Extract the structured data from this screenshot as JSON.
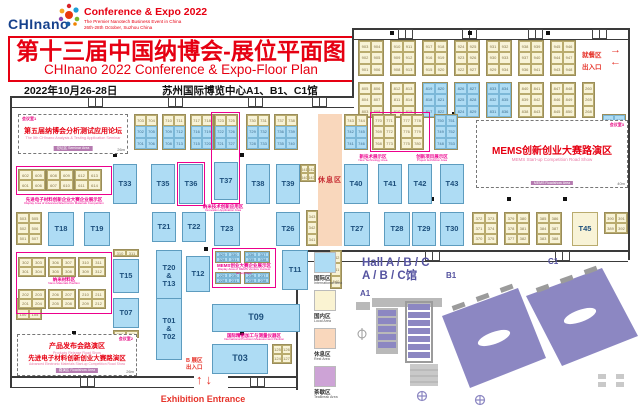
{
  "header": {
    "logo_text": "CHInano",
    "expo_line1": "Conference & Expo 2022",
    "expo_line2": "The Premier Nanotech Business Event in China",
    "expo_line3": "26th-28th October, Suzhou China",
    "title_cn": "第十三届中国纳博会-展位平面图",
    "title_en": "CHInano 2022 Conference & Expo-Floor Plan",
    "date": "2022年10月26-28日",
    "venue": "苏州国际博览中心A1、B1、C1馆"
  },
  "labels": {
    "dining": "就餐区",
    "dining_arrow": "→",
    "exit": "出入口",
    "exit_arrow": "←",
    "rest": "休息区",
    "b_hall": "B 展区",
    "b_entrance": "出入口",
    "arrow_up": "↑",
    "arrow_down": "↓",
    "exhibition_entrance": "Exhibition Entrance"
  },
  "rooms": [
    {
      "x": 18,
      "y": 114,
      "w": 110,
      "h": 40,
      "corner": "会议室1",
      "cpos": "l",
      "dim": "26m",
      "tag": "论坛区 Seminar Area",
      "lines": [
        {
          "t": "第五届纳博会分析测试应用论坛",
          "s": "cn",
          "fs": 7
        },
        {
          "t": "The 5th CHInano Analysis & Testing Application Seminar",
          "s": "en",
          "fs": 3.8
        }
      ]
    },
    {
      "x": 476,
      "y": 120,
      "w": 152,
      "h": 68,
      "corner": "会议室3",
      "cpos": "r",
      "dim": "40m",
      "tag": "MEMS Roadshow Area",
      "lines": [
        {
          "t": "MEMS创新创业大赛路演区",
          "s": "cn",
          "fs": 10
        },
        {
          "t": "MEMS Start-up Competition Road Show",
          "s": "en",
          "fs": 4.5
        }
      ]
    },
    {
      "x": 17,
      "y": 334,
      "w": 120,
      "h": 42,
      "corner": "会议室2",
      "cpos": "r",
      "dim": "26m",
      "tag": "路演区 Roadshow Area",
      "lines": [
        {
          "t": "产品发布会路演区",
          "s": "cn",
          "fs": 7
        },
        {
          "t": "Products Release Road Show",
          "s": "en",
          "fs": 3.6
        },
        {
          "t": "先进电子材料创新创业大赛路演区",
          "s": "cn",
          "fs": 6.5
        },
        {
          "t": "Advanced Electronic Materials Start-up Competition Road Show",
          "s": "en",
          "fs": 3.4
        }
      ]
    }
  ],
  "zones": [
    {
      "x": 16,
      "y": 166,
      "w": 96,
      "h": 29
    },
    {
      "x": 177,
      "y": 162,
      "w": 28,
      "h": 44
    },
    {
      "x": 211,
      "y": 112,
      "w": 29,
      "h": 92
    },
    {
      "x": 370,
      "y": 112,
      "w": 60,
      "h": 40
    },
    {
      "x": 16,
      "y": 252,
      "w": 96,
      "h": 62
    },
    {
      "x": 212,
      "y": 248,
      "w": 64,
      "h": 40
    }
  ],
  "zone_labels": [
    {
      "x": 2,
      "y": 197,
      "w": 124,
      "cn": "先进电子材料创新企业大赛企业展示区",
      "en": "Display Area of Advanced Electronics Materials Competition"
    },
    {
      "x": 168,
      "y": 204,
      "w": 110,
      "cn": "纳米技术创新应用区",
      "en": "Innovation Application Area"
    },
    {
      "x": 346,
      "y": 154,
      "w": 54,
      "cn": "新技术展示区",
      "en": "New Technology Area"
    },
    {
      "x": 400,
      "y": 154,
      "w": 64,
      "cn": "创新项目展示区",
      "en": "Project Exhibition Area"
    },
    {
      "x": 16,
      "y": 277,
      "w": 96,
      "cn": "纳米材料区",
      "en": "Nano Materials Pavilion"
    },
    {
      "x": 212,
      "y": 263,
      "w": 64,
      "cn": "MEMS创业大赛企业展示区",
      "en": "Display Area of MEMS Venture Contest Enterprises"
    },
    {
      "x": 196,
      "y": 333,
      "w": 116,
      "cn": "国际精密加工与测量仪器区",
      "en": "International Precision Measurement Pavilion"
    }
  ],
  "t_booths": [
    {
      "id": "T33",
      "x": 113,
      "y": 164,
      "w": 24,
      "h": 40
    },
    {
      "id": "T35",
      "x": 151,
      "y": 164,
      "w": 24,
      "h": 40
    },
    {
      "id": "T36",
      "x": 179,
      "y": 164,
      "w": 24,
      "h": 40
    },
    {
      "id": "T37",
      "x": 214,
      "y": 162,
      "w": 24,
      "h": 38
    },
    {
      "id": "T38",
      "x": 246,
      "y": 164,
      "w": 24,
      "h": 40
    },
    {
      "id": "T39",
      "x": 276,
      "y": 164,
      "w": 24,
      "h": 40
    },
    {
      "id": "T40",
      "x": 344,
      "y": 164,
      "w": 24,
      "h": 40
    },
    {
      "id": "T41",
      "x": 378,
      "y": 164,
      "w": 24,
      "h": 40
    },
    {
      "id": "T42",
      "x": 408,
      "y": 164,
      "w": 24,
      "h": 40
    },
    {
      "id": "T43",
      "x": 440,
      "y": 164,
      "w": 24,
      "h": 40
    },
    {
      "id": "T18",
      "x": 48,
      "y": 212,
      "w": 26,
      "h": 34
    },
    {
      "id": "T19",
      "x": 84,
      "y": 212,
      "w": 26,
      "h": 34
    },
    {
      "id": "T21",
      "x": 152,
      "y": 212,
      "w": 24,
      "h": 30
    },
    {
      "id": "T22",
      "x": 182,
      "y": 212,
      "w": 24,
      "h": 30
    },
    {
      "id": "T23",
      "x": 214,
      "y": 212,
      "w": 26,
      "h": 34
    },
    {
      "id": "T26",
      "x": 276,
      "y": 212,
      "w": 24,
      "h": 34
    },
    {
      "id": "T27",
      "x": 344,
      "y": 212,
      "w": 26,
      "h": 34
    },
    {
      "id": "T28",
      "x": 384,
      "y": 212,
      "w": 26,
      "h": 34
    },
    {
      "id": "T29",
      "x": 412,
      "y": 212,
      "w": 24,
      "h": 34
    },
    {
      "id": "T30",
      "x": 440,
      "y": 212,
      "w": 24,
      "h": 34
    },
    {
      "id": "T45",
      "x": 572,
      "y": 212,
      "w": 26,
      "h": 34,
      "cream": 1
    },
    {
      "id": "T20T13",
      "label": "T20\n&\nT13",
      "x": 156,
      "y": 250,
      "w": 26,
      "h": 52
    },
    {
      "id": "T15",
      "x": 113,
      "y": 259,
      "w": 26,
      "h": 34
    },
    {
      "id": "T12",
      "x": 186,
      "y": 256,
      "w": 24,
      "h": 36
    },
    {
      "id": "T11",
      "x": 282,
      "y": 250,
      "w": 26,
      "h": 40
    },
    {
      "id": "T07",
      "x": 113,
      "y": 298,
      "w": 26,
      "h": 30
    },
    {
      "id": "T01T02",
      "label": "T01\n&\nT02",
      "x": 156,
      "y": 298,
      "w": 26,
      "h": 62
    },
    {
      "id": "T09",
      "x": 212,
      "y": 304,
      "w": 88,
      "h": 28,
      "fs": 9
    },
    {
      "id": "T03",
      "x": 212,
      "y": 344,
      "w": 56,
      "h": 30,
      "fs": 9
    }
  ],
  "blocks": [
    {
      "x": 358,
      "y": 40,
      "n": [
        "903",
        "904",
        "902",
        "905",
        "901",
        "906"
      ]
    },
    {
      "x": 390,
      "y": 40,
      "n": [
        "910",
        "911",
        "909",
        "912",
        "908",
        "913"
      ]
    },
    {
      "x": 422,
      "y": 40,
      "n": [
        "917",
        "918",
        "916",
        "919",
        "915",
        "920"
      ]
    },
    {
      "x": 454,
      "y": 40,
      "n": [
        "924",
        "925",
        "923",
        "926",
        "922",
        "927"
      ]
    },
    {
      "x": 486,
      "y": 40,
      "n": [
        "931",
        "932",
        "930",
        "933",
        "929",
        "934"
      ]
    },
    {
      "x": 518,
      "y": 40,
      "n": [
        "938",
        "939",
        "937",
        "940",
        "936",
        "941"
      ]
    },
    {
      "x": 550,
      "y": 40,
      "n": [
        "945",
        "946",
        "944",
        "947",
        "943",
        "948"
      ]
    },
    {
      "x": 358,
      "y": 82,
      "n": [
        "805",
        "806",
        "804",
        "807",
        "803",
        "808"
      ]
    },
    {
      "x": 390,
      "y": 82,
      "n": [
        "812",
        "813",
        "811",
        "814",
        "810",
        "815"
      ]
    },
    {
      "x": 422,
      "y": 82,
      "k": "b",
      "n": [
        "819",
        "820",
        "818",
        "821",
        "817",
        "822"
      ]
    },
    {
      "x": 454,
      "y": 82,
      "k": "b",
      "n": [
        "826",
        "827",
        "825",
        "828",
        "824",
        "829"
      ]
    },
    {
      "x": 486,
      "y": 82,
      "k": "b",
      "n": [
        "833",
        "834",
        "832",
        "835",
        "831",
        "836"
      ]
    },
    {
      "x": 518,
      "y": 82,
      "n": [
        "840",
        "841",
        "839",
        "842",
        "838",
        "843"
      ]
    },
    {
      "x": 550,
      "y": 82,
      "n": [
        "847",
        "848",
        "846",
        "849",
        "845",
        "850"
      ]
    },
    {
      "x": 582,
      "y": 82,
      "c": 1,
      "n": [
        "260",
        "265",
        "268"
      ]
    },
    {
      "x": 134,
      "y": 114,
      "k": "m",
      "cw": 12,
      "n": [
        "703",
        "704",
        "702",
        "705",
        "701",
        "706"
      ]
    },
    {
      "x": 162,
      "y": 114,
      "k": "m",
      "cw": 12,
      "n": [
        "710",
        "711",
        "709",
        "712",
        "708",
        "713"
      ]
    },
    {
      "x": 190,
      "y": 114,
      "k": "m",
      "cw": 12,
      "n": [
        "717",
        "718",
        "716",
        "719",
        "715",
        "720"
      ]
    },
    {
      "x": 214,
      "y": 114,
      "k": "m",
      "cw": 12,
      "n": [
        "723",
        "725",
        "722",
        "726",
        "721",
        "727"
      ]
    },
    {
      "x": 246,
      "y": 114,
      "k": "m",
      "cw": 12,
      "n": [
        "730",
        "731",
        "729",
        "732",
        "728",
        "733"
      ]
    },
    {
      "x": 274,
      "y": 114,
      "k": "m",
      "cw": 12,
      "n": [
        "737",
        "738",
        "736",
        "739",
        "735",
        "740"
      ]
    },
    {
      "x": 344,
      "y": 114,
      "k": "m",
      "cw": 12,
      "n": [
        "743",
        "744",
        "742",
        "745",
        "741",
        "746"
      ]
    },
    {
      "x": 372,
      "y": 114,
      "cw": 12,
      "n": [
        "770",
        "771",
        "769",
        "772",
        "768",
        "773"
      ]
    },
    {
      "x": 400,
      "y": 114,
      "cw": 12,
      "n": [
        "777",
        "778",
        "776",
        "779",
        "775",
        "780"
      ]
    },
    {
      "x": 434,
      "y": 114,
      "k": "b",
      "cw": 12,
      "n": [
        "750",
        "751",
        "749",
        "752",
        "748",
        "753"
      ]
    },
    {
      "x": 602,
      "y": 114,
      "k": "b",
      "cw": 12,
      "n": [
        "786",
        "787",
        "785",
        "788",
        "784",
        "789"
      ]
    },
    {
      "x": 18,
      "y": 169,
      "cw": 14,
      "ch": 11,
      "n": [
        "602",
        "605",
        "601",
        "606"
      ]
    },
    {
      "x": 46,
      "y": 169,
      "cw": 14,
      "ch": 11,
      "n": [
        "608",
        "609",
        "607",
        "610"
      ]
    },
    {
      "x": 74,
      "y": 169,
      "cw": 14,
      "ch": 11,
      "n": [
        "612",
        "613",
        "611",
        "614"
      ]
    },
    {
      "x": 300,
      "y": 164,
      "cw": 8,
      "ch": 9,
      "n": [
        "641",
        "642",
        "640",
        "643"
      ]
    },
    {
      "x": 16,
      "y": 212,
      "ch": 11,
      "n": [
        "503",
        "505",
        "502",
        "506",
        "501",
        "507"
      ]
    },
    {
      "x": 306,
      "y": 210,
      "c": 1,
      "cw": 12,
      "n": [
        "343",
        "342",
        "341"
      ]
    },
    {
      "x": 472,
      "y": 212,
      "ch": 11,
      "n": [
        "372",
        "373",
        "371",
        "374",
        "370",
        "375"
      ]
    },
    {
      "x": 504,
      "y": 212,
      "ch": 11,
      "n": [
        "379",
        "380",
        "378",
        "381",
        "377",
        "382"
      ]
    },
    {
      "x": 536,
      "y": 212,
      "ch": 11,
      "n": [
        "385",
        "386",
        "384",
        "387",
        "383",
        "388"
      ]
    },
    {
      "x": 604,
      "y": 212,
      "cw": 12,
      "ch": 11,
      "n": [
        "390",
        "391",
        "389",
        "392"
      ]
    },
    {
      "x": 113,
      "y": 249,
      "ch": 8,
      "n": [
        "310",
        "311"
      ]
    },
    {
      "x": 113,
      "y": 330,
      "ch": 8,
      "n": [
        "210",
        "211"
      ]
    },
    {
      "x": 16,
      "y": 298,
      "ch": 11,
      "n": [
        "101",
        "102",
        "100",
        "105"
      ]
    },
    {
      "x": 18,
      "y": 257,
      "cw": 14,
      "ch": 10,
      "n": [
        "302",
        "303",
        "301",
        "304"
      ]
    },
    {
      "x": 48,
      "y": 257,
      "cw": 14,
      "ch": 10,
      "n": [
        "306",
        "307",
        "305",
        "308"
      ]
    },
    {
      "x": 78,
      "y": 257,
      "cw": 14,
      "ch": 10,
      "n": [
        "310",
        "311",
        "309",
        "312"
      ]
    },
    {
      "x": 18,
      "y": 289,
      "cw": 14,
      "ch": 10,
      "n": [
        "202",
        "203",
        "201",
        "204"
      ]
    },
    {
      "x": 48,
      "y": 289,
      "cw": 14,
      "ch": 10,
      "n": [
        "206",
        "207",
        "205",
        "208"
      ]
    },
    {
      "x": 78,
      "y": 289,
      "cw": 14,
      "ch": 10,
      "n": [
        "210",
        "211",
        "209",
        "212"
      ]
    },
    {
      "x": 215,
      "y": 251,
      "k": "b",
      "ch": 6,
      "n": [
        "329",
        "330",
        "328",
        "331"
      ]
    },
    {
      "x": 244,
      "y": 251,
      "k": "b",
      "ch": 6,
      "n": [
        "336",
        "337",
        "335",
        "338"
      ]
    },
    {
      "x": 215,
      "y": 272,
      "k": "b",
      "ch": 6,
      "n": [
        "229",
        "230",
        "228",
        "231"
      ]
    },
    {
      "x": 244,
      "y": 272,
      "k": "b",
      "ch": 6,
      "n": [
        "236",
        "237",
        "235",
        "238"
      ]
    },
    {
      "x": 330,
      "y": 250,
      "c": 1,
      "cw": 12,
      "ch": 13,
      "n": [
        "542",
        "541",
        "540"
      ]
    },
    {
      "x": 272,
      "y": 344,
      "cw": 10,
      "ch": 10,
      "n": [
        "125",
        "126",
        "124",
        "127"
      ]
    }
  ],
  "venue_map": {
    "title1": "Hall A / B / C",
    "title2": "A / B / C馆",
    "halls": [
      "A1",
      "B1",
      "C1"
    ],
    "legend": [
      {
        "color": "#aedcf4",
        "cn": "国际区",
        "en": "International Area"
      },
      {
        "color": "#faf3d2",
        "cn": "国内区",
        "en": "Local Area"
      },
      {
        "color": "#f9d7bc",
        "cn": "休息区",
        "en": "Rest Area"
      },
      {
        "color": "#cda3d6",
        "cn": "茶歇区",
        "en": "TeaBreak Area"
      }
    ]
  }
}
